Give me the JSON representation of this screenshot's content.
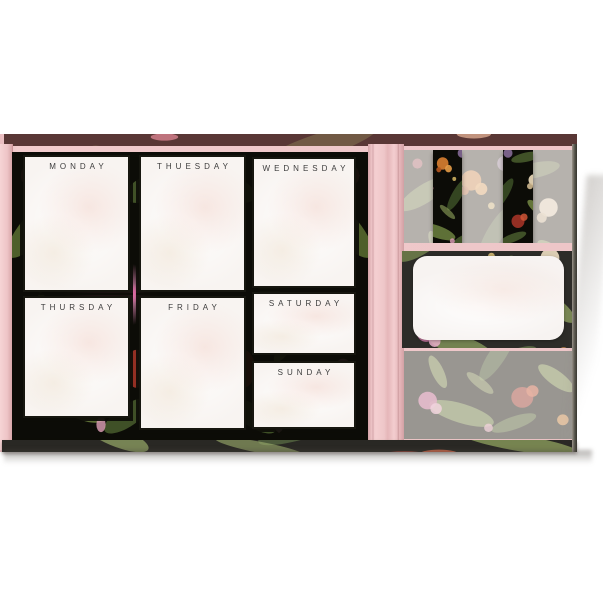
{
  "planner": {
    "days": [
      {
        "label": "MONDAY"
      },
      {
        "label": "THUESDAY"
      },
      {
        "label": "WEDNESDAY"
      },
      {
        "label": "THURSDAY"
      },
      {
        "label": "FRIDAY"
      },
      {
        "label": "SATURDAY"
      },
      {
        "label": "SUNDAY"
      }
    ]
  },
  "colors": {
    "cover_pink": "#efc8ca",
    "spine_pink": "#f3cdce",
    "floral_background": "#0c0c07",
    "notepad_paper": "#f8f4f1",
    "day_label_text": "#3d3d3d",
    "leaf_green": "#6d8340",
    "flower_orange": "#d07a2e",
    "flower_pink": "#e958a0"
  }
}
